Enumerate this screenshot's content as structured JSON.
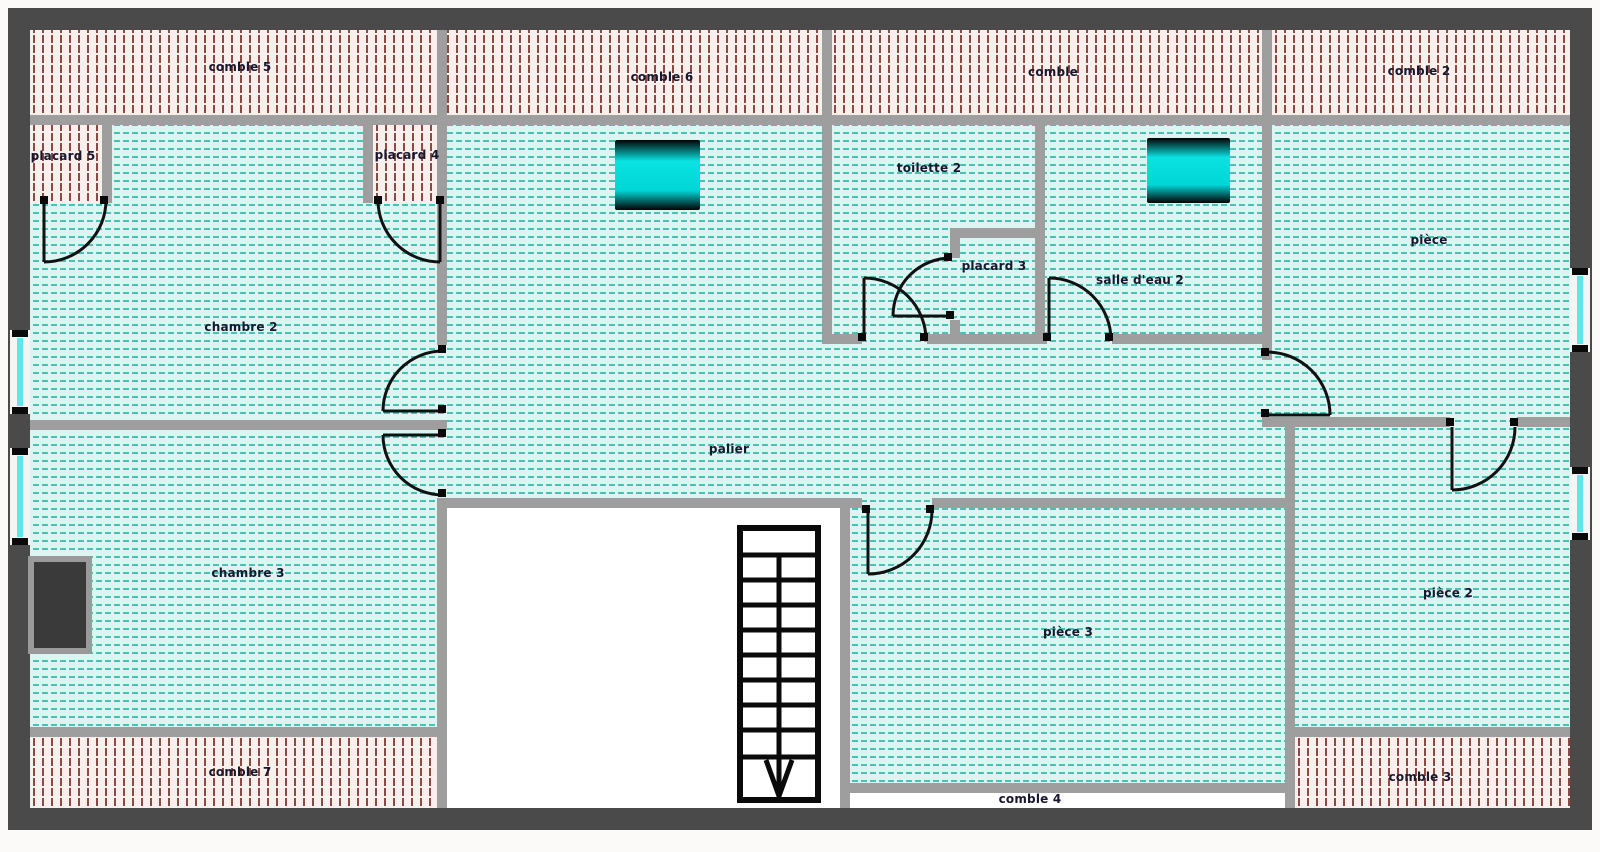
{
  "plan": {
    "type": "floor-plan-upper-storey",
    "rooms": {
      "comble5": {
        "label": "comble 5"
      },
      "comble6": {
        "label": "comble 6"
      },
      "comble": {
        "label": "comble"
      },
      "comble2": {
        "label": "comble 2"
      },
      "placard5": {
        "label": "placard 5"
      },
      "placard4": {
        "label": "placard 4"
      },
      "chambre2": {
        "label": "chambre 2"
      },
      "toilette2": {
        "label": "toilette 2"
      },
      "placard3": {
        "label": "placard 3"
      },
      "salledeau2": {
        "label": "salle d'eau 2"
      },
      "piece": {
        "label": "pièce"
      },
      "palier": {
        "label": "palier"
      },
      "chambre3": {
        "label": "chambre 3"
      },
      "piece2": {
        "label": "pièce 2"
      },
      "piece3": {
        "label": "pièce 3"
      },
      "comble7": {
        "label": "comble 7"
      },
      "comble4": {
        "label": "comble 4"
      },
      "comble3": {
        "label": "comble 3"
      }
    },
    "features": {
      "stairs": {
        "visible_treads": 10,
        "direction_arrow": "down"
      },
      "wall_windows": 4,
      "roof_windows": 2,
      "doors": 10,
      "chimney_blocks": 1
    },
    "colors": {
      "exterior_wall": "#4a4a4a",
      "interior_wall": "#9e9e9e",
      "comble_fill": "#f9efec",
      "comble_hatch": "#8d4a42",
      "room_fill": "#dcf5f1",
      "room_hatch": "#43c4b4",
      "window_glass": "#62e6ea",
      "roof_window": "#00dede",
      "door_line": "#111111",
      "label_text": "#17172e"
    }
  }
}
